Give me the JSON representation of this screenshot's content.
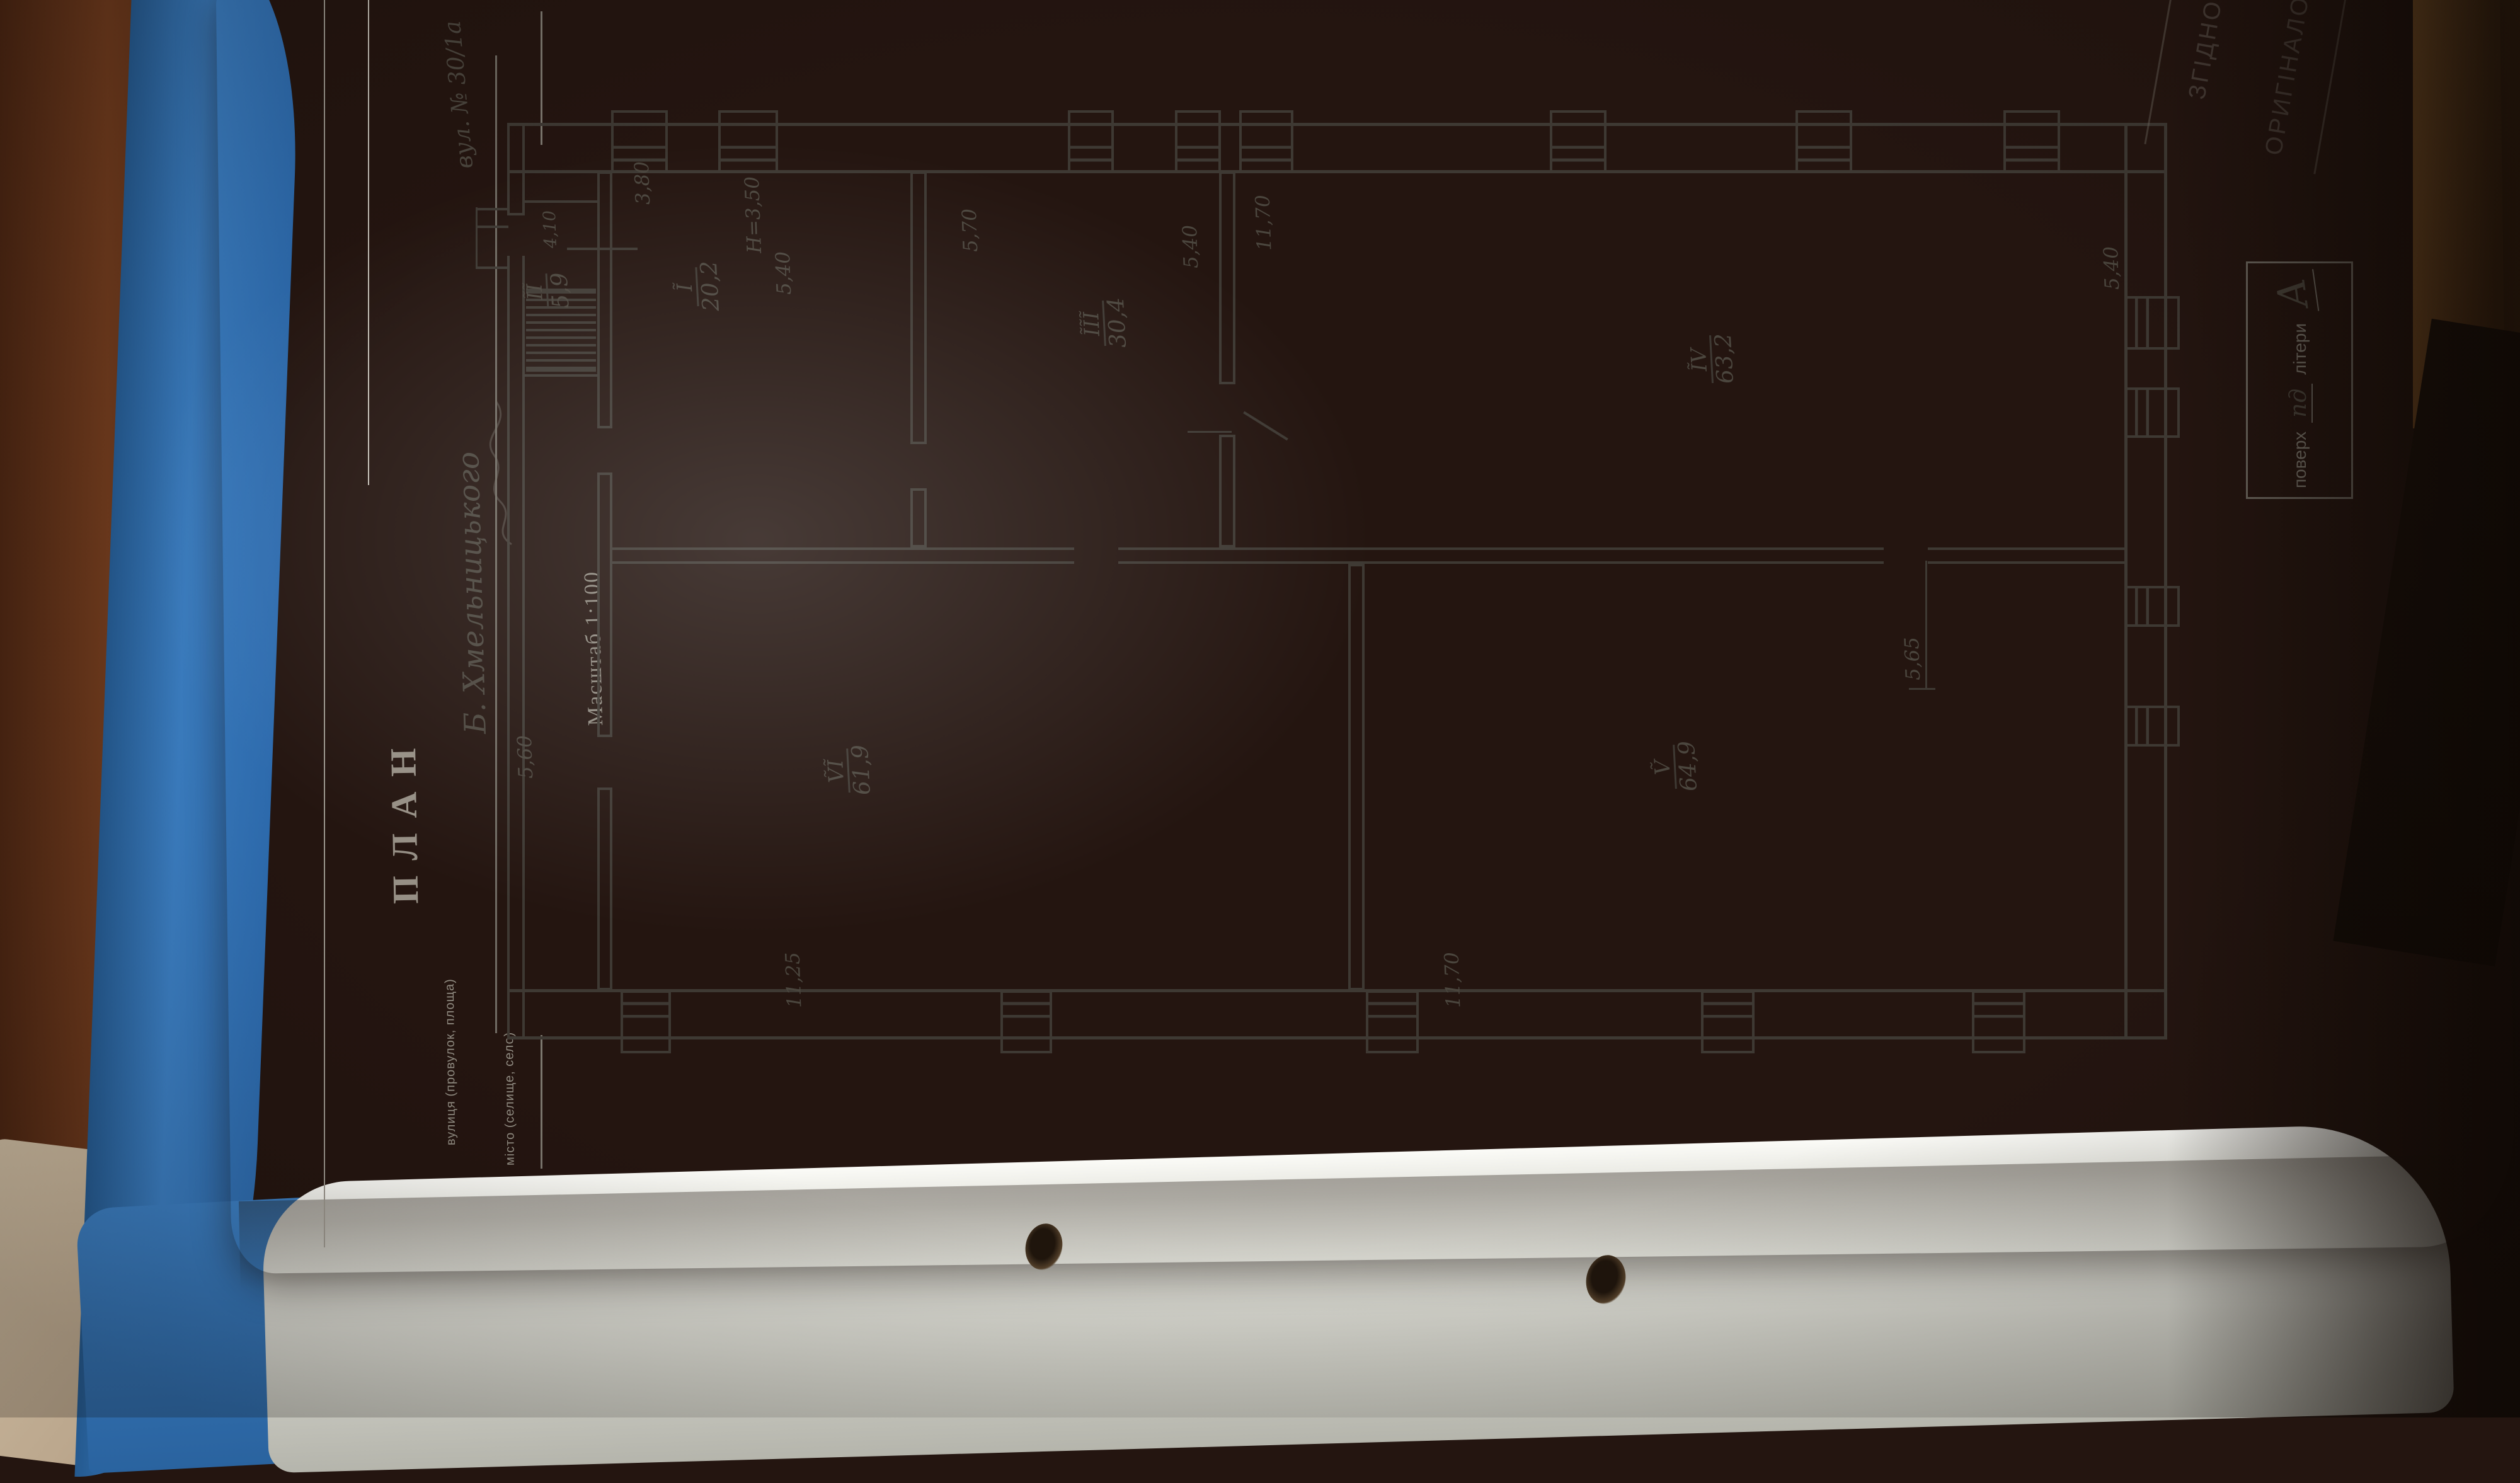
{
  "plan": {
    "title": "ПЛАН",
    "scale_label": "Масштаб 1:100",
    "height_note": "H=3,50",
    "header": {
      "street_label": "вулиця (провулок, площа)",
      "street_value": "Б. Хмельницького",
      "address_value": "вул. № 30/1а",
      "city_label": "місто (селище, село)"
    },
    "rooms": [
      {
        "num": "Ĩ",
        "area": "20,2"
      },
      {
        "num": "ĨĨ",
        "area": "5,9"
      },
      {
        "num": "ĨĨĨ",
        "area": "30,4"
      },
      {
        "num": "ĨV",
        "area": "63,2"
      },
      {
        "num": "Ṽ",
        "area": "64,9"
      },
      {
        "num": "ṼĨ",
        "area": "61,9"
      }
    ],
    "dims": {
      "corridor": "4,10",
      "room1_w": "3,80",
      "room1_d": "5,40",
      "room3_w": "5,70",
      "room3_d": "5,40",
      "room4_w": "11,70",
      "room4_d": "5,40",
      "room5_d": "5,65",
      "room5_w": "11,70",
      "room6_w": "11,25",
      "annex": "5,60"
    },
    "stamp_box": {
      "field1_label": "поверх",
      "field1_value": "пд",
      "field2_label": "літери",
      "field2_value": "А"
    },
    "corner_stamp": {
      "line1": "ЗГІДНО",
      "line2": "ОРИГІНАЛОМ"
    }
  },
  "colors": {
    "ink": "#3E3933",
    "paper": "#ECECE7",
    "folder_blue": "#3B7EC2",
    "desk_wood": "#6E3A1D"
  }
}
